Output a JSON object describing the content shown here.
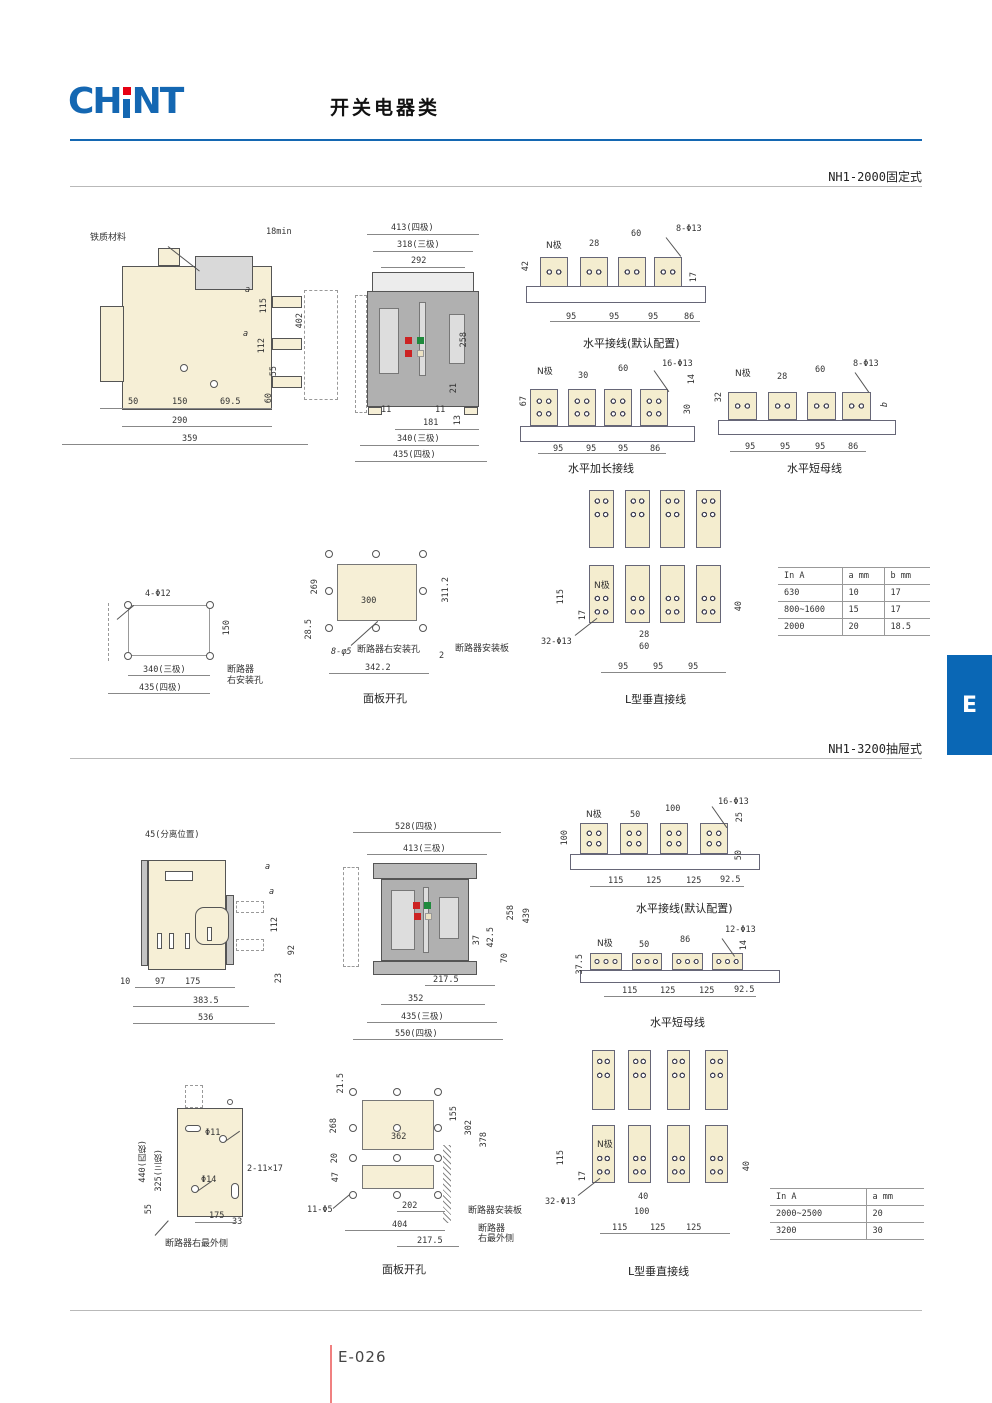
{
  "header": {
    "logo_left": "CH",
    "logo_right": "NT",
    "title": "开关电器类"
  },
  "colors": {
    "brand_blue": "#1467B2",
    "tab_blue": "#0A67B5",
    "accent_red": "#E60012",
    "indicator_green": "#1E8A3C",
    "indicator_red": "#CC2222",
    "busbar_cream": "#F4EDCF"
  },
  "s1": {
    "label": "NH1-2000固定式",
    "side": {
      "callout": "铁质材料",
      "top": "18min",
      "a1": "a",
      "v115": "115",
      "v402": "402",
      "a2": "a",
      "v112": "112",
      "v55": "55",
      "v60": "60",
      "b1": "50",
      "b2": "150",
      "b3": "69.5",
      "b4": "290",
      "b5": "359"
    },
    "front": {
      "t1": "413(四极)",
      "t2": "318(三极)",
      "t3": "292",
      "r1": "258",
      "r2": "21",
      "r3": "13",
      "b1": "11",
      "b2": "11",
      "b3": "181",
      "b4": "340(三极)",
      "b5": "435(四极)"
    },
    "hd": {
      "title": "水平接线(默认配置)",
      "n": "N极",
      "d1": "28",
      "d2": "60",
      "holes": "8-Φ13",
      "v1": "42",
      "v2": "17",
      "p1": "95",
      "p2": "95",
      "p3": "95",
      "p4": "86"
    },
    "he": {
      "title": "水平加长接线",
      "n": "N极",
      "d1": "30",
      "d2": "60",
      "holes": "16-Φ13",
      "v1": "14",
      "v2": "67",
      "v3": "30",
      "p1": "95",
      "p2": "95",
      "p3": "95",
      "p4": "86"
    },
    "hs": {
      "title": "水平短母线",
      "n": "N极",
      "d1": "28",
      "d2": "60",
      "holes": "8-Φ13",
      "v1": "32",
      "v2": "b",
      "p1": "95",
      "p2": "95",
      "p3": "95",
      "p4": "86"
    },
    "mh": {
      "holes": "4-Φ12",
      "v1": "150",
      "b1": "340(三极)",
      "b2": "435(四极)",
      "note1": "断路器",
      "note2": "右安装孔"
    },
    "pc": {
      "title": "面板开孔",
      "v1": "269",
      "v2": "28.5",
      "d1": "300",
      "v3": "311.2",
      "holes": "8-φ5",
      "note1": "断路器右安装孔",
      "d2": "2",
      "note2": "断路器安装板",
      "b1": "342.2"
    },
    "lv": {
      "title": "L型垂直接线",
      "n": "N极",
      "v1": "115",
      "v2": "17",
      "holes": "32-Φ13",
      "d1": "28",
      "d2": "60",
      "p1": "95",
      "p2": "95",
      "p3": "95",
      "v3": "40"
    },
    "table": {
      "h": [
        "In A",
        "a mm",
        "b mm"
      ],
      "r": [
        [
          "630",
          "10",
          "17"
        ],
        [
          "800~1600",
          "15",
          "17"
        ],
        [
          "2000",
          "20",
          "18.5"
        ]
      ]
    }
  },
  "s2": {
    "label": "NH1-3200抽屉式",
    "side": {
      "callout": "45(分离位置)",
      "a1": "a",
      "a2": "a",
      "v112": "112",
      "v92": "92",
      "v23": "23",
      "b1": "10",
      "b2": "97",
      "b3": "175",
      "b4": "383.5",
      "b5": "536"
    },
    "front": {
      "t1": "528(四极)",
      "t2": "413(三极)",
      "r1": "258",
      "r2": "439",
      "r3": "37",
      "r4": "42.5",
      "r5": "70",
      "b1": "217.5",
      "b2": "352",
      "b3": "435(三极)",
      "b4": "550(四极)"
    },
    "hd": {
      "title": "水平接线(默认配置)",
      "n": "N极",
      "d1": "50",
      "d2": "100",
      "holes": "16-Φ13",
      "v1": "25",
      "v2": "100",
      "v3": "50",
      "p1": "115",
      "p2": "125",
      "p3": "125",
      "p4": "92.5"
    },
    "hs": {
      "title": "水平短母线",
      "n": "N极",
      "d1": "50",
      "d2": "86",
      "holes": "12-Φ13",
      "v1": "14",
      "v2": "37.5",
      "p1": "115",
      "p2": "125",
      "p3": "125",
      "p4": "92.5"
    },
    "mp": {
      "v1": "440(四极)",
      "v2": "325(三极)",
      "h1": "Φ11",
      "h2": "Φ14",
      "slot": "2-11×17",
      "v3": "55",
      "b1": "175",
      "b2": "33",
      "note": "断路器右最外侧"
    },
    "pc": {
      "title": "面板开孔",
      "v1": "21.5",
      "v2": "268",
      "v3": "20",
      "v4": "47",
      "v5": "155",
      "v6": "302",
      "v7": "378",
      "d1": "362",
      "holes": "11-Φ5",
      "b1": "202",
      "b2": "404",
      "b3": "217.5",
      "note1": "断路器安装板",
      "note2": "断路器",
      "note3": "右最外侧"
    },
    "lv": {
      "title": "L型垂直接线",
      "n": "N极",
      "v1": "115",
      "v2": "17",
      "holes": "32-Φ13",
      "d1": "40",
      "d2": "100",
      "p1": "115",
      "p2": "125",
      "p3": "125",
      "v3": "40"
    },
    "table": {
      "h": [
        "In A",
        "a mm"
      ],
      "r": [
        [
          "2000~2500",
          "20"
        ],
        [
          "3200",
          "30"
        ]
      ]
    }
  },
  "footer": {
    "page": "E-026",
    "tab": "E"
  }
}
